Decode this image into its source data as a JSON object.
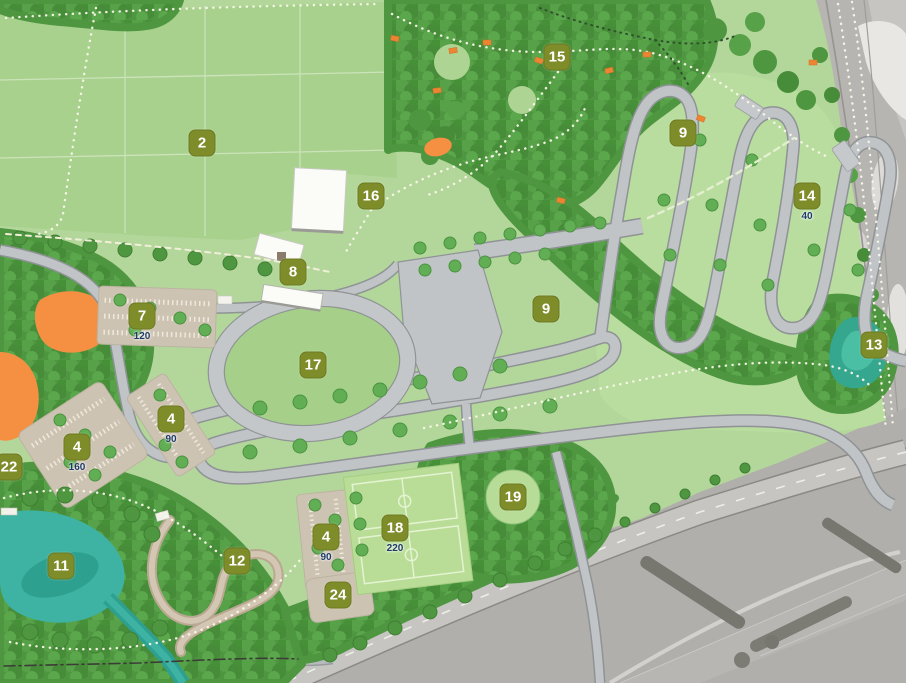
{
  "map_title": "Park masterplan",
  "colors": {
    "marker_bg": "#7e8c2a",
    "marker_text": "#ffffff",
    "capacity_text": "#1d3a64",
    "parkland_green": "#b3d79a",
    "field_green": "#a8d18d",
    "woodland_green": "#4f9641",
    "road_grey": "#c0c4c6",
    "parking_tan": "#cdc3b2",
    "water_teal": "#3eb3a3",
    "highlight_orange": "#f59043",
    "aerial_grey": "#b4b2ae"
  },
  "markers": [
    {
      "label": "2",
      "x": 202,
      "y": 143,
      "sub": ""
    },
    {
      "label": "15",
      "x": 557,
      "y": 57,
      "sub": ""
    },
    {
      "label": "9",
      "x": 683,
      "y": 133,
      "sub": ""
    },
    {
      "label": "16",
      "x": 371,
      "y": 196,
      "sub": ""
    },
    {
      "label": "14",
      "x": 807,
      "y": 196,
      "sub": "40"
    },
    {
      "label": "8",
      "x": 293,
      "y": 272,
      "sub": ""
    },
    {
      "label": "7",
      "x": 142,
      "y": 316,
      "sub": "120"
    },
    {
      "label": "9",
      "x": 546,
      "y": 309,
      "sub": ""
    },
    {
      "label": "13",
      "x": 874,
      "y": 345,
      "sub": ""
    },
    {
      "label": "17",
      "x": 313,
      "y": 365,
      "sub": ""
    },
    {
      "label": "4",
      "x": 171,
      "y": 419,
      "sub": "90"
    },
    {
      "label": "4",
      "x": 77,
      "y": 447,
      "sub": "160"
    },
    {
      "label": "22",
      "x": 9,
      "y": 467,
      "sub": ""
    },
    {
      "label": "19",
      "x": 513,
      "y": 497,
      "sub": ""
    },
    {
      "label": "18",
      "x": 395,
      "y": 528,
      "sub": "220"
    },
    {
      "label": "4",
      "x": 326,
      "y": 537,
      "sub": "90"
    },
    {
      "label": "12",
      "x": 237,
      "y": 561,
      "sub": ""
    },
    {
      "label": "11",
      "x": 61,
      "y": 566,
      "sub": ""
    },
    {
      "label": "24",
      "x": 338,
      "y": 595,
      "sub": ""
    }
  ]
}
